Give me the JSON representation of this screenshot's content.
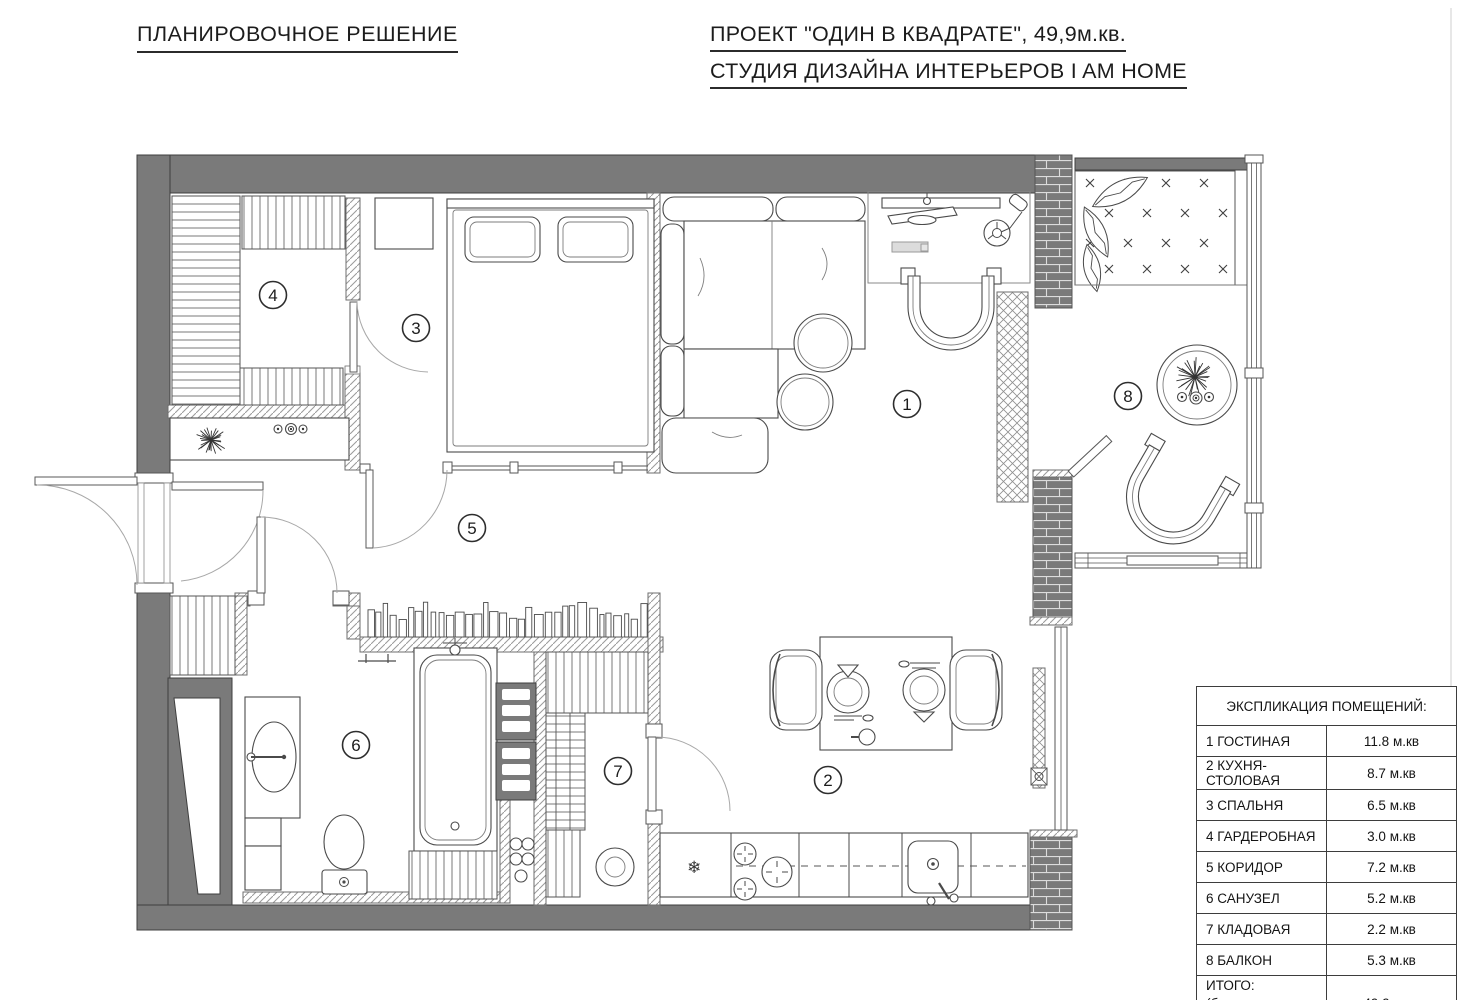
{
  "header": {
    "plan_title": "ПЛАНИРОВОЧНОЕ РЕШЕНИЕ",
    "project_title": "ПРОЕКТ \"ОДИН В КВАДРАТЕ\", 49,9м.кв.",
    "studio_title": "СТУДИЯ ДИЗАЙНА ИНТЕРЬЕРОВ I AM HOME"
  },
  "legend": {
    "title": "ЭКСПЛИКАЦИЯ ПОМЕЩЕНИЙ:",
    "rows": [
      {
        "label": "1 ГОСТИНАЯ",
        "area": "11.8 м.кв"
      },
      {
        "label": "2 КУХНЯ-СТОЛОВАЯ",
        "area": "8.7 м.кв"
      },
      {
        "label": "3 СПАЛЬНЯ",
        "area": "6.5 м.кв"
      },
      {
        "label": "4 ГАРДЕРОБНАЯ",
        "area": "3.0 м.кв"
      },
      {
        "label": "5 КОРИДОР",
        "area": "7.2 м.кв"
      },
      {
        "label": "6 САНУЗЕЛ",
        "area": "5.2 м.кв"
      },
      {
        "label": "7 КЛАДОВАЯ",
        "area": "2.2 м.кв"
      },
      {
        "label": "8 БАЛКОН",
        "area": "5.3 м.кв"
      }
    ],
    "total": {
      "label_line1": "ИТОГО:",
      "label_line2": "(без учета перегородок)",
      "area": "49.9 м.кв"
    }
  },
  "plan": {
    "room_markers": [
      {
        "num": "1",
        "x": 907,
        "y": 404
      },
      {
        "num": "2",
        "x": 828,
        "y": 780
      },
      {
        "num": "3",
        "x": 416,
        "y": 328
      },
      {
        "num": "4",
        "x": 273,
        "y": 295
      },
      {
        "num": "5",
        "x": 472,
        "y": 528
      },
      {
        "num": "6",
        "x": 356,
        "y": 745
      },
      {
        "num": "7",
        "x": 618,
        "y": 771
      },
      {
        "num": "8",
        "x": 1128,
        "y": 396
      }
    ],
    "icons": {
      "fridge_snowflake": "❄"
    }
  },
  "colors": {
    "wall": "#7a7a7a",
    "line": "#4a4a4a",
    "marker_stroke": "#2e2e2e"
  }
}
